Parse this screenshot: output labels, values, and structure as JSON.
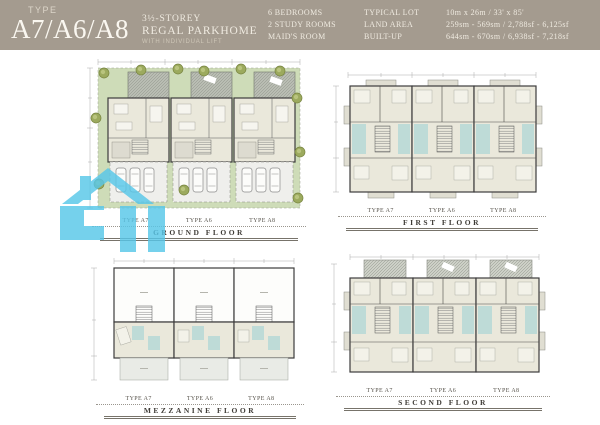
{
  "header": {
    "type_label": "TYPE",
    "model": "A7/A6/A8",
    "storey": "3½-STOREY",
    "product_name": "REGAL PARKHOME",
    "tagline": "WITH INDIVIDUAL LIFT",
    "specs": {
      "features": [
        "6 BEDROOMS",
        "2 STUDY ROOMS",
        "MAID'S ROOM"
      ],
      "attributes": [
        "TYPICAL LOT",
        "LAND AREA",
        "BUILT-UP"
      ],
      "values": [
        "10m x 26m / 33' x 85'",
        "259sm - 569sm / 2,788sf - 6,125sf",
        "644sm - 670sm / 6,938sf - 7,218sf"
      ]
    }
  },
  "plans": {
    "ground": {
      "name": "GROUND FLOOR",
      "types": [
        "TYPE A7",
        "TYPE A6",
        "TYPE A8"
      ]
    },
    "first": {
      "name": "FIRST FLOOR",
      "types": [
        "TYPE A7",
        "TYPE A6",
        "TYPE A8"
      ]
    },
    "mezzanine": {
      "name": "MEZZANINE FLOOR",
      "types": [
        "TYPE A7",
        "TYPE A6",
        "TYPE A8"
      ]
    },
    "second": {
      "name": "SECOND FLOOR",
      "types": [
        "TYPE A7",
        "TYPE A6",
        "TYPE A8"
      ]
    }
  },
  "watermark": {
    "icon": "house-logo-watermark-icon",
    "color": "#57C7E9"
  },
  "colors": {
    "header_bg": "#A49B8F",
    "header_text": "#EFEAE0",
    "lawn": "#CEDCB8",
    "room": "#EAE8DB",
    "bath": "#BEDBD7",
    "wall": "#3C3C3C",
    "deck": "#B9BDB3"
  }
}
